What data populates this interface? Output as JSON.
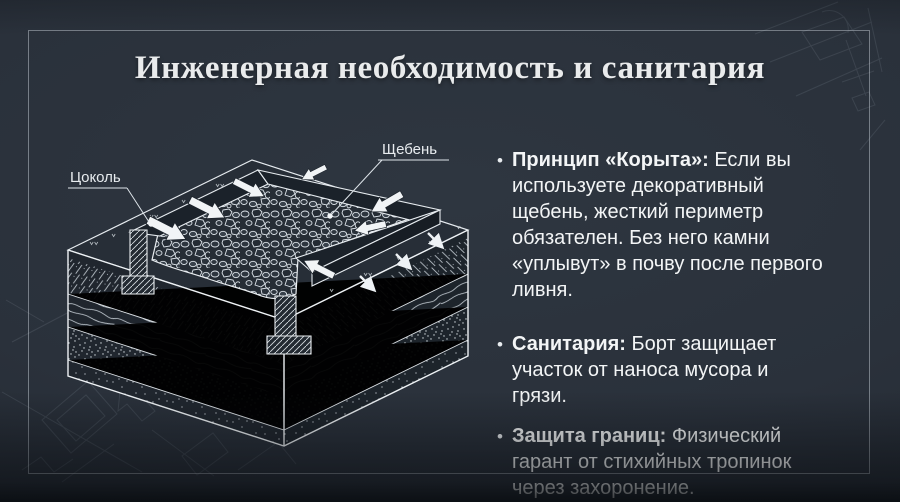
{
  "slide": {
    "title": "Инженерная необходимость и санитария"
  },
  "diagram": {
    "labels": [
      {
        "text": "Цоколь"
      },
      {
        "text": "Щебень"
      }
    ]
  },
  "right_column": {
    "bullet_glyph": "•",
    "bullets": [
      {
        "lead": "Принцип «Корыта»:",
        "text": "Если вы используете декоративный щебень, жесткий периметр обязателен. Без него камни «уплывут» в почву после первого ливня."
      },
      {
        "lead": "Санитария:",
        "text": "Борт защищает участок от наноса мусора и грязи."
      },
      {
        "lead": "Защита границ:",
        "text": "Физический гарант от стихийных тропинок через захоронение."
      }
    ]
  },
  "colors": {
    "background": "#2a313b",
    "title_text": "#e9ebec",
    "body_text": "#f3f5f6",
    "line_art": "#e9edf0",
    "frame_line": "#c3cbd4"
  }
}
